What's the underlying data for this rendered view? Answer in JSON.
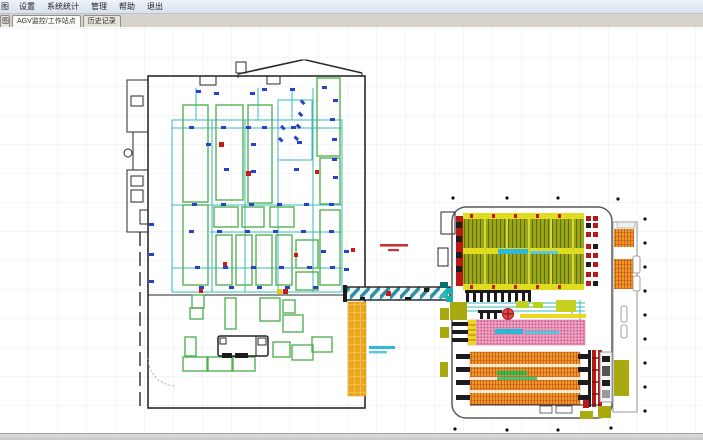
{
  "menu_bar": {
    "items": [
      "图",
      "设置",
      "系统统计",
      "管理",
      "帮助",
      "退出"
    ]
  },
  "tab_bar": {
    "clipped_tab_label": "图",
    "tabs": [
      {
        "label": "AGV监控/工作站点",
        "active": true
      },
      {
        "label": "历史记录",
        "active": false
      }
    ]
  },
  "canvas": {
    "grid_spacing_px": 29,
    "background": "#ffffff",
    "grid_color": "#e7ebee"
  },
  "colors": {
    "wall": "#2a2a2a",
    "zone_green": "#55b055",
    "path_teal": "#3ab9b9",
    "station_marker_blue": "#2843c8",
    "marker_red": "#cc1818",
    "rack_olive": "#9aa518",
    "rack_pink": "#eb9dc0",
    "rack_orange": "#e89c28",
    "buffer_yellow": "#eaa71e",
    "rail_red": "#b81818",
    "annotation_red": "#cc3333",
    "annotation_cyan": "#30b8d8",
    "annotation_green": "#2ab858"
  }
}
